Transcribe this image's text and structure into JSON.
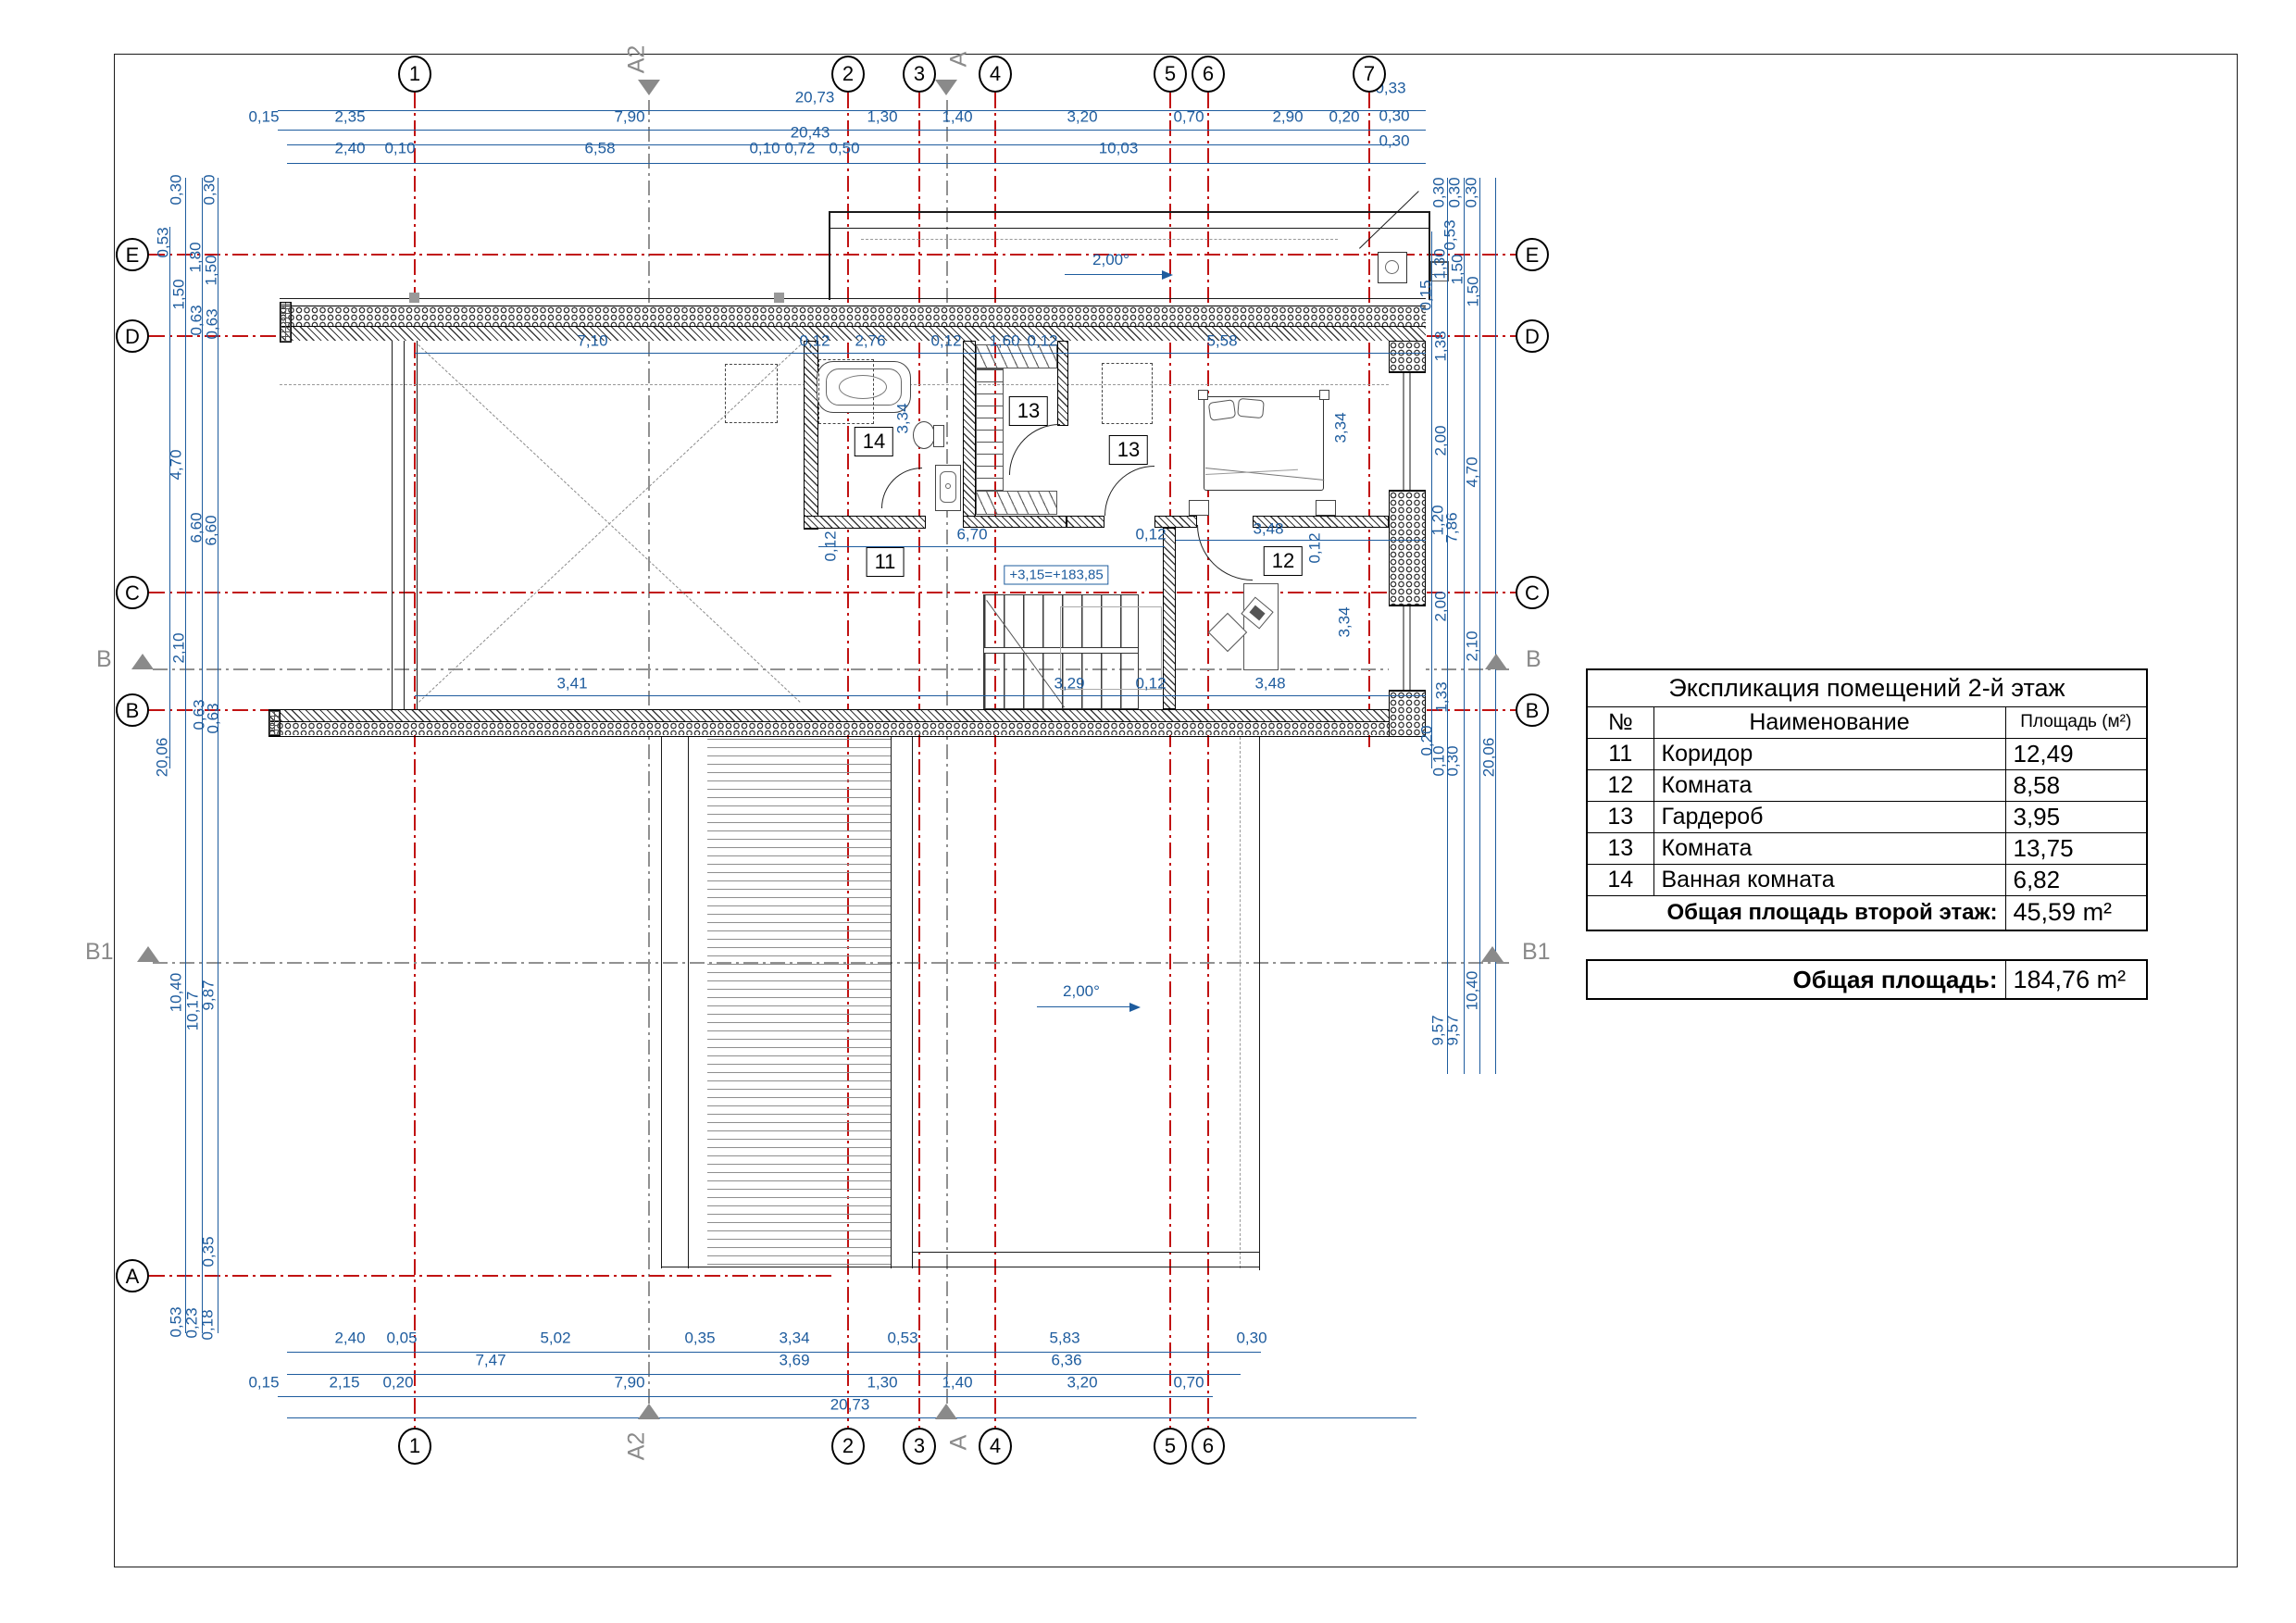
{
  "drawing": {
    "slope_top": "2,00°",
    "slope_bottom": "2,00°",
    "elevation": "+3,15=+183,85",
    "rooms": {
      "r11": "11",
      "r12": "12",
      "r13a": "13",
      "r13b": "13",
      "r14": "14"
    }
  },
  "axes": {
    "top": [
      "1",
      "2",
      "3",
      "4",
      "5",
      "6",
      "7"
    ],
    "bottom": [
      "1",
      "2",
      "3",
      "4",
      "5",
      "6"
    ],
    "left": [
      "E",
      "D",
      "C",
      "B",
      "A"
    ],
    "right": [
      "E",
      "D",
      "C",
      "B"
    ],
    "markers": {
      "a2": "A2",
      "a": "A",
      "b": "B",
      "b1": "B1"
    }
  },
  "dims": {
    "top_total1": "20,73",
    "top_total2": "20,43",
    "top_row1": [
      "0,15",
      "2,35",
      "7,90",
      "1,30",
      "1,40",
      "3,20",
      "0,70",
      "2,90",
      "0,20",
      "0,33",
      "0,30",
      "0,30"
    ],
    "top_row2": [
      "2,40",
      "0,10",
      "6,58",
      "0,10",
      "0,72",
      "0,50",
      "10,03"
    ],
    "bottom_row1": [
      "2,40",
      "0,05",
      "5,02",
      "0,35",
      "3,34",
      "0,53",
      "5,83",
      "0,30"
    ],
    "bottom_row2": [
      "7,47",
      "3,69",
      "6,36"
    ],
    "bottom_row3": [
      "0,15",
      "2,15",
      "0,20",
      "7,90",
      "1,30",
      "1,40",
      "3,20",
      "0,70"
    ],
    "bottom_total": "20,73",
    "left": [
      "0,30",
      "0,30",
      "0,53",
      "1,80",
      "1,50",
      "1,50",
      "0,63",
      "0,63",
      "4,70",
      "6,60",
      "6,60",
      "2,10",
      "0,63",
      "0,63",
      "20,06",
      "10,40",
      "10,17",
      "9,87",
      "0,35",
      "0,53",
      "0,23",
      "0,18"
    ],
    "right": [
      "0,30",
      "0,30",
      "0,30",
      "0,53",
      "1,30",
      "1,50",
      "1,50",
      "0,15",
      "1,38",
      "2,00",
      "4,70",
      "1,20",
      "7,86",
      "2,00",
      "2,10",
      "1,33",
      "0,20",
      "0,10",
      "0,30",
      "20,06",
      "10,40",
      "9,57",
      "9,57"
    ],
    "plan": [
      "7,10",
      "0,12",
      "2,76",
      "0,12",
      "1,60",
      "0,12",
      "5,58",
      "3,34",
      "3,34",
      "3,34",
      "0,12",
      "0,12",
      "6,70",
      "0,12",
      "3,48",
      "3,41",
      "3,29",
      "0,12",
      "3,48"
    ]
  },
  "table": {
    "title": "Экспликация помещений 2-й этаж",
    "col_num": "№",
    "col_name": "Наименование",
    "col_area": "Площадь (м²)",
    "rows": [
      {
        "num": "11",
        "name": "Коридор",
        "area": "12,49"
      },
      {
        "num": "12",
        "name": "Комната",
        "area": "8,58"
      },
      {
        "num": "13",
        "name": "Гардероб",
        "area": "3,95"
      },
      {
        "num": "13",
        "name": "Комната",
        "area": "13,75"
      },
      {
        "num": "14",
        "name": "Ванная комната",
        "area": "6,82"
      }
    ],
    "floor_total_label": "Общая площадь второй этаж:",
    "floor_total_value": "45,59 m²",
    "grand_total_label": "Общая площадь:",
    "grand_total_value": "184,76 m²"
  },
  "colors": {
    "axis_red": "#c11212",
    "dim_blue": "#1e5c9e",
    "marker_gray": "#8a8a8a",
    "line_black": "#1a1a1a"
  }
}
